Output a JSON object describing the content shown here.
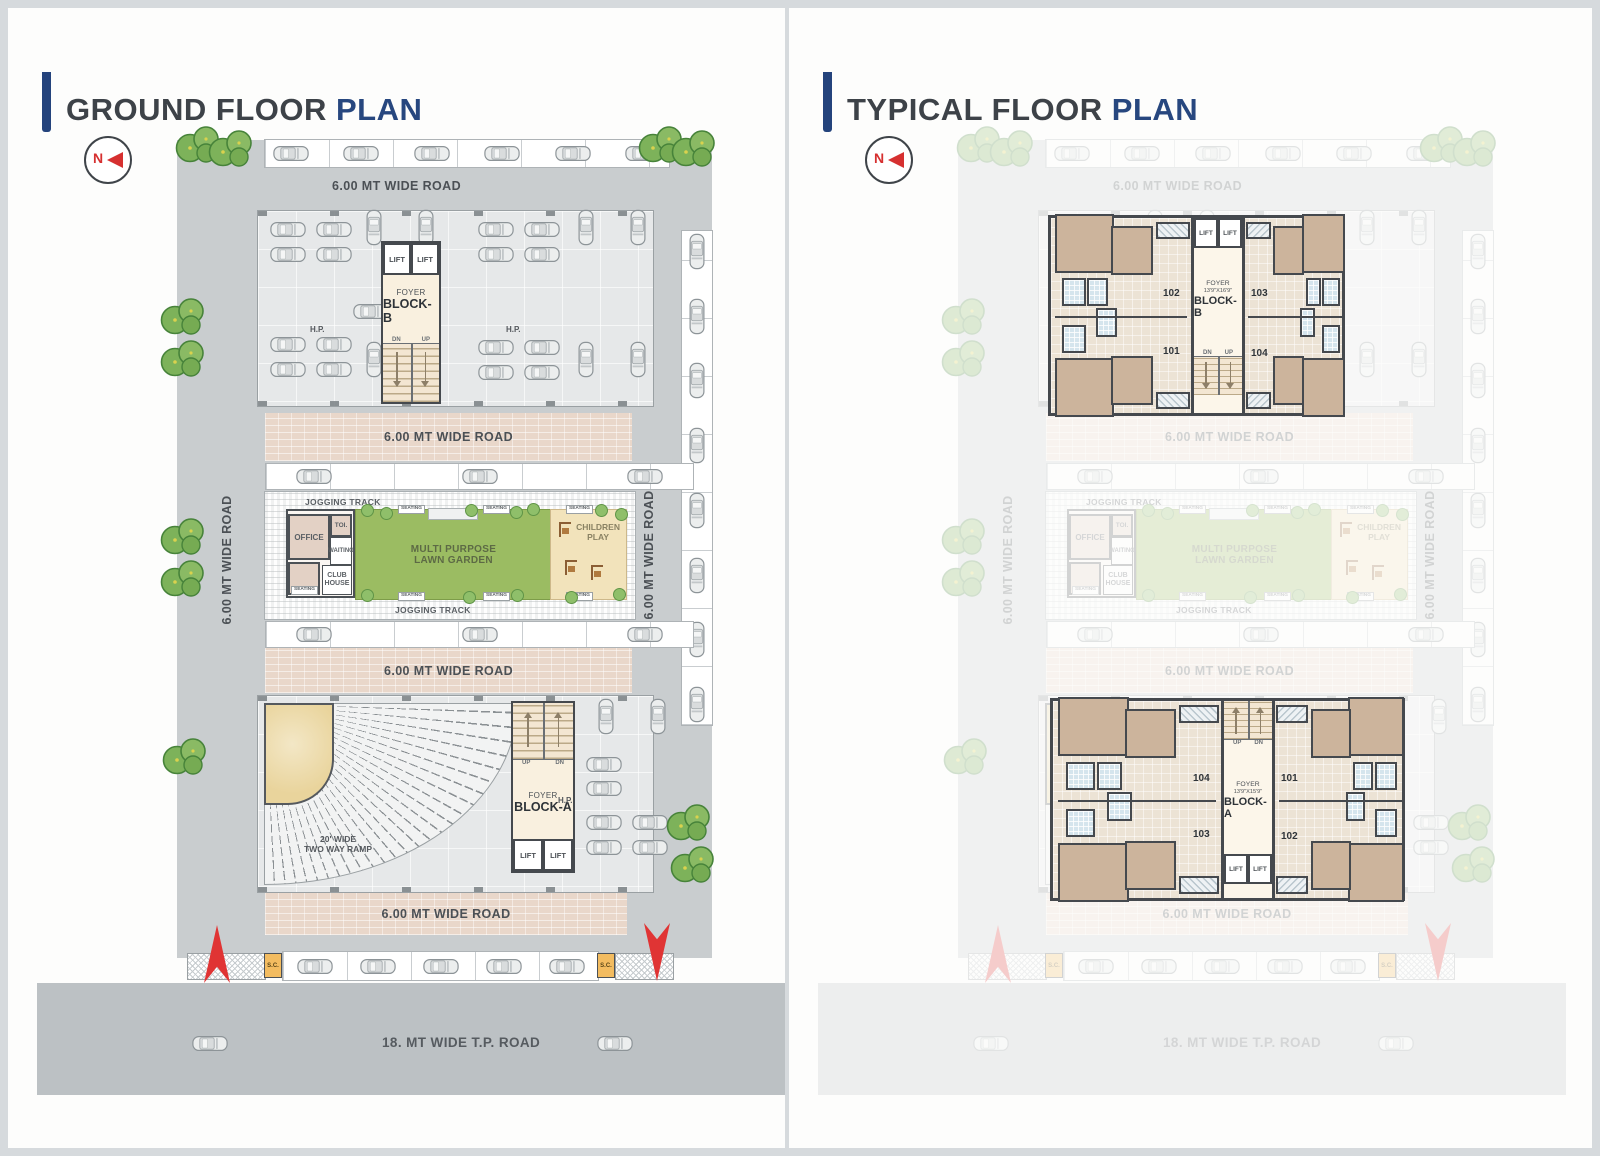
{
  "page": {
    "left_title_main": "GROUND FLOOR",
    "left_title_accent": "PLAN",
    "right_title_main": "TYPICAL FLOOR",
    "right_title_accent": "PLAN",
    "north": "N"
  },
  "labels": {
    "road6": "6.00 MT WIDE ROAD",
    "road18": "18. MT WIDE T.P. ROAD",
    "jogging": "JOGGING TRACK",
    "office": "OFFICE",
    "toilet": "TOI.",
    "waiting": "WAITING",
    "club_house": "CLUB\nHOUSE",
    "seating": "SEATING",
    "lawn": "MULTI PURPOSE\nLAWN GARDEN",
    "children": "CHILDREN\nPLAY",
    "lift": "LIFT",
    "foyer": "FOYER",
    "dn": "DN",
    "up": "UP",
    "hp": "H.P.",
    "sc": "S.C.",
    "ramp": "20' WIDE\nTWO WAY RAMP",
    "block_a": "BLOCK-A",
    "block_b": "BLOCK-B"
  },
  "typical": {
    "block_b": {
      "foyer_size": "13'9\"X16'9\"",
      "units": {
        "tl": "102",
        "tr": "103",
        "bl": "101",
        "br": "104"
      }
    },
    "block_a": {
      "foyer_size": "13'9\"X15'9\"",
      "units": {
        "tl": "104",
        "tr": "101",
        "bl": "103",
        "br": "102"
      }
    }
  },
  "colors": {
    "accent_blue": "#27477f",
    "title_gray": "#3d4248",
    "north_red": "#d63030",
    "lawn_green": "#9bbc62",
    "brick_road": "#e9d7ca",
    "site_gray": "#c9cdcf"
  }
}
